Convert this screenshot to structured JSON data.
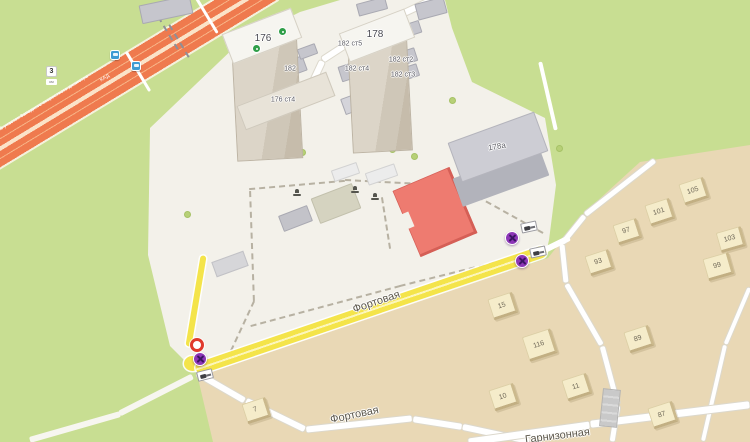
{
  "map": {
    "streets": {
      "fortovaya_main": "Фортовая",
      "fortovaya_south": "Фортовая",
      "garnizonnaya": "Гарнизонная"
    },
    "highway": {
      "label": "105 участок Западного скоростного диаметра",
      "ramp_label": "КАД",
      "km_marker": "3",
      "km_marker_sub": "км"
    },
    "buildings": {
      "tower_left": "176",
      "tower_right": "178",
      "b182": "182",
      "b182s5": "182 ст5",
      "b182s4": "182 ст4",
      "b182s2": "182 ст2",
      "b182s3": "182 ст3",
      "b176s4": "176 ст4",
      "b178a": "178а"
    },
    "houses": [
      {
        "label": "105"
      },
      {
        "label": "101"
      },
      {
        "label": "97"
      },
      {
        "label": "93"
      },
      {
        "label": "103"
      },
      {
        "label": "99"
      },
      {
        "label": "15"
      },
      {
        "label": "116"
      },
      {
        "label": "89"
      },
      {
        "label": "11"
      },
      {
        "label": "10"
      },
      {
        "label": "87"
      },
      {
        "label": "7"
      }
    ],
    "icons": {
      "no_stopping": "no-stopping-sign",
      "prohibition": "prohibition-ring-sign",
      "tow_plate": "tow-away-info-plate",
      "bus_stop": "bus-stop-icon",
      "roof_poi": "green-organization-icon",
      "yard_poi": "playground-icon"
    },
    "colors": {
      "route_yellow": "#f4e44a",
      "highway_orange": "#ef7a4e",
      "sign_purple": "#8d36b7",
      "ring_red": "#e03a2c",
      "building_red": "#ee7b70",
      "land_green": "#c8de92",
      "district_beige": "#e9d8b5"
    }
  }
}
